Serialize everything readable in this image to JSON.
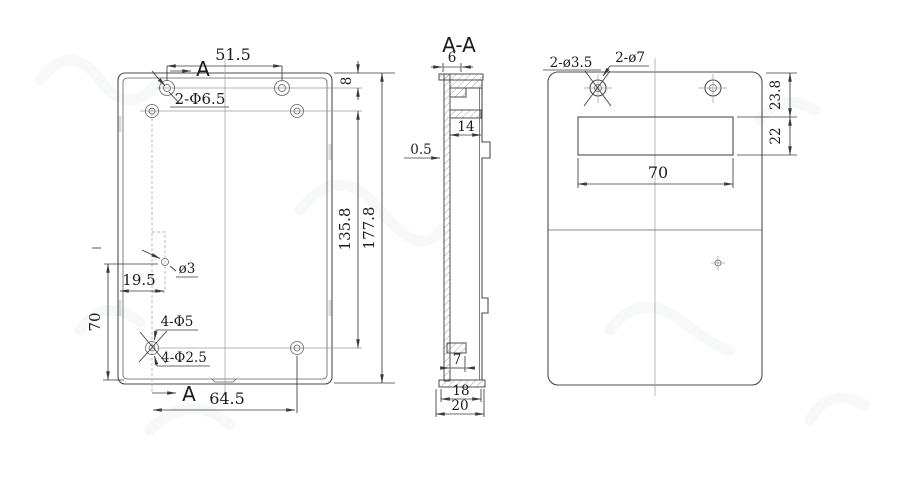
{
  "front_view": {
    "section_label_top": "A",
    "section_label_bottom": "A",
    "dims": {
      "hole_spacing_top": "51.5",
      "top_hole_offset": "8",
      "hole_pattern_height": "135.8",
      "overall_height": "177.8",
      "notch_offset": "19.5",
      "notch_to_bottom": "70",
      "bottom_hole_spacing": "64.5"
    },
    "labels": {
      "top_holes": "2-Φ6.5",
      "notch_hole": "ø3",
      "corner_holes": "4-Φ5",
      "corner_holes_pilot": "4-Φ2.5"
    }
  },
  "section_view": {
    "title": "A-A",
    "dims": {
      "top_step_width": "6",
      "inner_width": "14",
      "wall_thickness": "0.5",
      "rib_width": "7",
      "inner_depth": "18",
      "overall_depth": "20"
    }
  },
  "rear_view": {
    "labels": {
      "mount_holes_small": "2-ø3.5",
      "mount_holes_large": "2-ø7"
    },
    "dims": {
      "slot_top_offset": "23.8",
      "slot_height": "22",
      "slot_width": "70"
    }
  },
  "colors": {
    "line": "#4d4d4d",
    "dim_line": "#3a3a3a",
    "text": "#1c1c1c",
    "centerline": "#9a9aa0",
    "hatch": "#8a8a8a",
    "tab_fill": "#dcdcdc",
    "background": "#ffffff",
    "watermark": "#8f9aa8"
  }
}
